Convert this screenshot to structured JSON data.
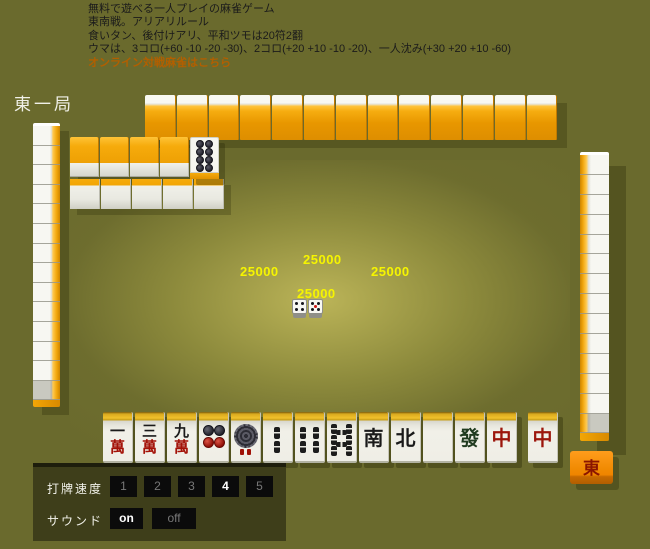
{
  "header": {
    "lines": [
      "無料で遊べる一人プレイの麻雀ゲーム",
      "東南戦。アリアリルール",
      "食いタン、後付けアリ、平和ツモは20符2翻",
      "ウマは、3コロ(+60 -10 -20 -30)、2コロ(+20 +10 -10 -20)、一人沈み(+30 +20 +10 -60)"
    ],
    "link": "オンライン対戦麻雀はこちら"
  },
  "round_label": "東一局",
  "scores": {
    "top": "25000",
    "left": "25000",
    "right": "25000",
    "bottom": "25000"
  },
  "dice": [
    {
      "value": 4,
      "red_center": false
    },
    {
      "value": 5,
      "red_center": true
    }
  ],
  "dora_indicator": {
    "tile": "8-pin",
    "circle_count": 8
  },
  "walls": {
    "left_count": 14,
    "right_count": 14,
    "top_hand_count": 13,
    "dead_wall_stacks": 4,
    "dead_wall_front": 5
  },
  "seat_wind": "東",
  "hand": {
    "tiles": [
      {
        "id": "1man",
        "kind": "man",
        "top": "一",
        "bottom": "萬"
      },
      {
        "id": "3man",
        "kind": "man",
        "top": "三",
        "bottom": "萬"
      },
      {
        "id": "9man",
        "kind": "man",
        "top": "九",
        "bottom": "萬"
      },
      {
        "id": "4pin",
        "kind": "pin4"
      },
      {
        "id": "1pin",
        "kind": "pin1"
      },
      {
        "id": "2sou",
        "kind": "sou",
        "sticks": 2
      },
      {
        "id": "4sou",
        "kind": "sou",
        "sticks": 4
      },
      {
        "id": "8sou",
        "kind": "sou",
        "sticks": 8
      },
      {
        "id": "south",
        "kind": "honor",
        "char": "南",
        "color": "#1a1a1a"
      },
      {
        "id": "north",
        "kind": "honor",
        "char": "北",
        "color": "#1a1a1a"
      },
      {
        "id": "haku",
        "kind": "honor",
        "char": "",
        "color": "#1a1a1a"
      },
      {
        "id": "hatsu",
        "kind": "honor",
        "char": "發",
        "color": "#1f3a1f"
      },
      {
        "id": "chun",
        "kind": "honor",
        "char": "中",
        "color": "#9c160c"
      },
      {
        "id": "chun2",
        "kind": "honor",
        "char": "中",
        "color": "#9c160c",
        "drawn": true
      }
    ]
  },
  "controls": {
    "speed_label": "打牌速度",
    "speeds": [
      "1",
      "2",
      "3",
      "4",
      "5"
    ],
    "speed_selected": "4",
    "sound_label": "サウンド",
    "sound_options": [
      "on",
      "off"
    ],
    "sound_selected": "on"
  },
  "colors": {
    "table": "#6a6a2d",
    "tile_back_orange": "#f0a30a",
    "score_yellow": "#f6f500",
    "link_orange": "#b25f00",
    "panel_bg": "#3e3e1a"
  }
}
